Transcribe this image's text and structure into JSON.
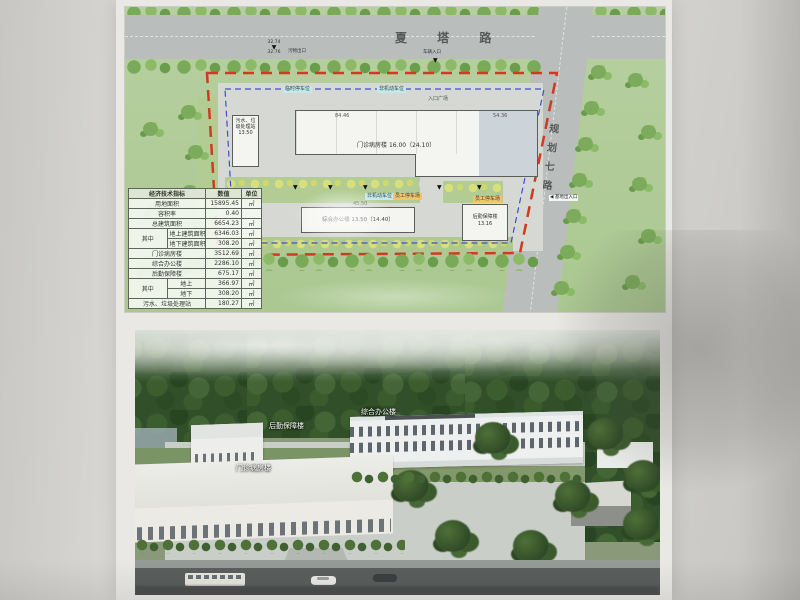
{
  "colors": {
    "boundary_red": "#d03a20",
    "setback_blue": "#3d51c6",
    "grass_green": "#b5cd9c",
    "parking_cyan": "#c2e9ec",
    "parking_orange": "#f2c46e"
  },
  "site_plan": {
    "top_road_label": "夏 塔 路",
    "right_road_label": "规划七路",
    "entry_plaza_label": "入口广场",
    "site_entrance_label": "基地出入口",
    "site_entrance_arrow": "◀",
    "waste_exit": {
      "label": "污物出口",
      "elev_top": "32.74",
      "elev_bottom": "32.76",
      "marker": "▼"
    },
    "vehicle_entrance": {
      "label": "车辆入口",
      "marker": "▼"
    },
    "entry_marker": "▼",
    "parking_tags": {
      "temp": "临时停车位",
      "nonmotor": "非机动车位",
      "staff": "员工停车场"
    },
    "buildings": {
      "main": {
        "name": "门诊病房楼",
        "note": "16.00（24.10）",
        "dim_left": "84.46",
        "dim_right": "54.36"
      },
      "office": {
        "name": "综合办公楼",
        "note": "13.50（14.40）",
        "dim": "45.50"
      },
      "logistics": {
        "name": "后勤保障楼",
        "note": "13.16"
      },
      "sewage": {
        "name": "污水、垃圾处理站",
        "note": "13.50"
      }
    },
    "table": {
      "title": "经济技术指标",
      "col_value": "数值",
      "col_unit": "单位",
      "merge_label": "其中",
      "rows": [
        {
          "label": "用地面积",
          "value": "15895.45",
          "unit": "㎡"
        },
        {
          "label": "容积率",
          "value": "0.40",
          "unit": ""
        },
        {
          "label": "总建筑面积",
          "value": "6654.23",
          "unit": "㎡"
        },
        {
          "label": "地上建筑面积",
          "value": "6346.03",
          "unit": "㎡"
        },
        {
          "label": "地下建筑面积",
          "value": "308.20",
          "unit": "㎡"
        },
        {
          "label": "门诊病房楼",
          "value": "3512.69",
          "unit": "㎡"
        },
        {
          "label": "综合办公楼",
          "value": "2286.10",
          "unit": "㎡"
        },
        {
          "label": "后勤保障楼",
          "value": "675.17",
          "unit": "㎡"
        },
        {
          "label": "地上",
          "value": "366.97",
          "unit": "㎡"
        },
        {
          "label": "地下",
          "value": "308.20",
          "unit": "㎡"
        },
        {
          "label": "污水、垃圾处理站",
          "value": "180.27",
          "unit": "㎡"
        }
      ]
    }
  },
  "rendering": {
    "labels": {
      "office": "综合办公楼",
      "logistics": "后勤保障楼",
      "main": "门诊病房楼"
    }
  }
}
